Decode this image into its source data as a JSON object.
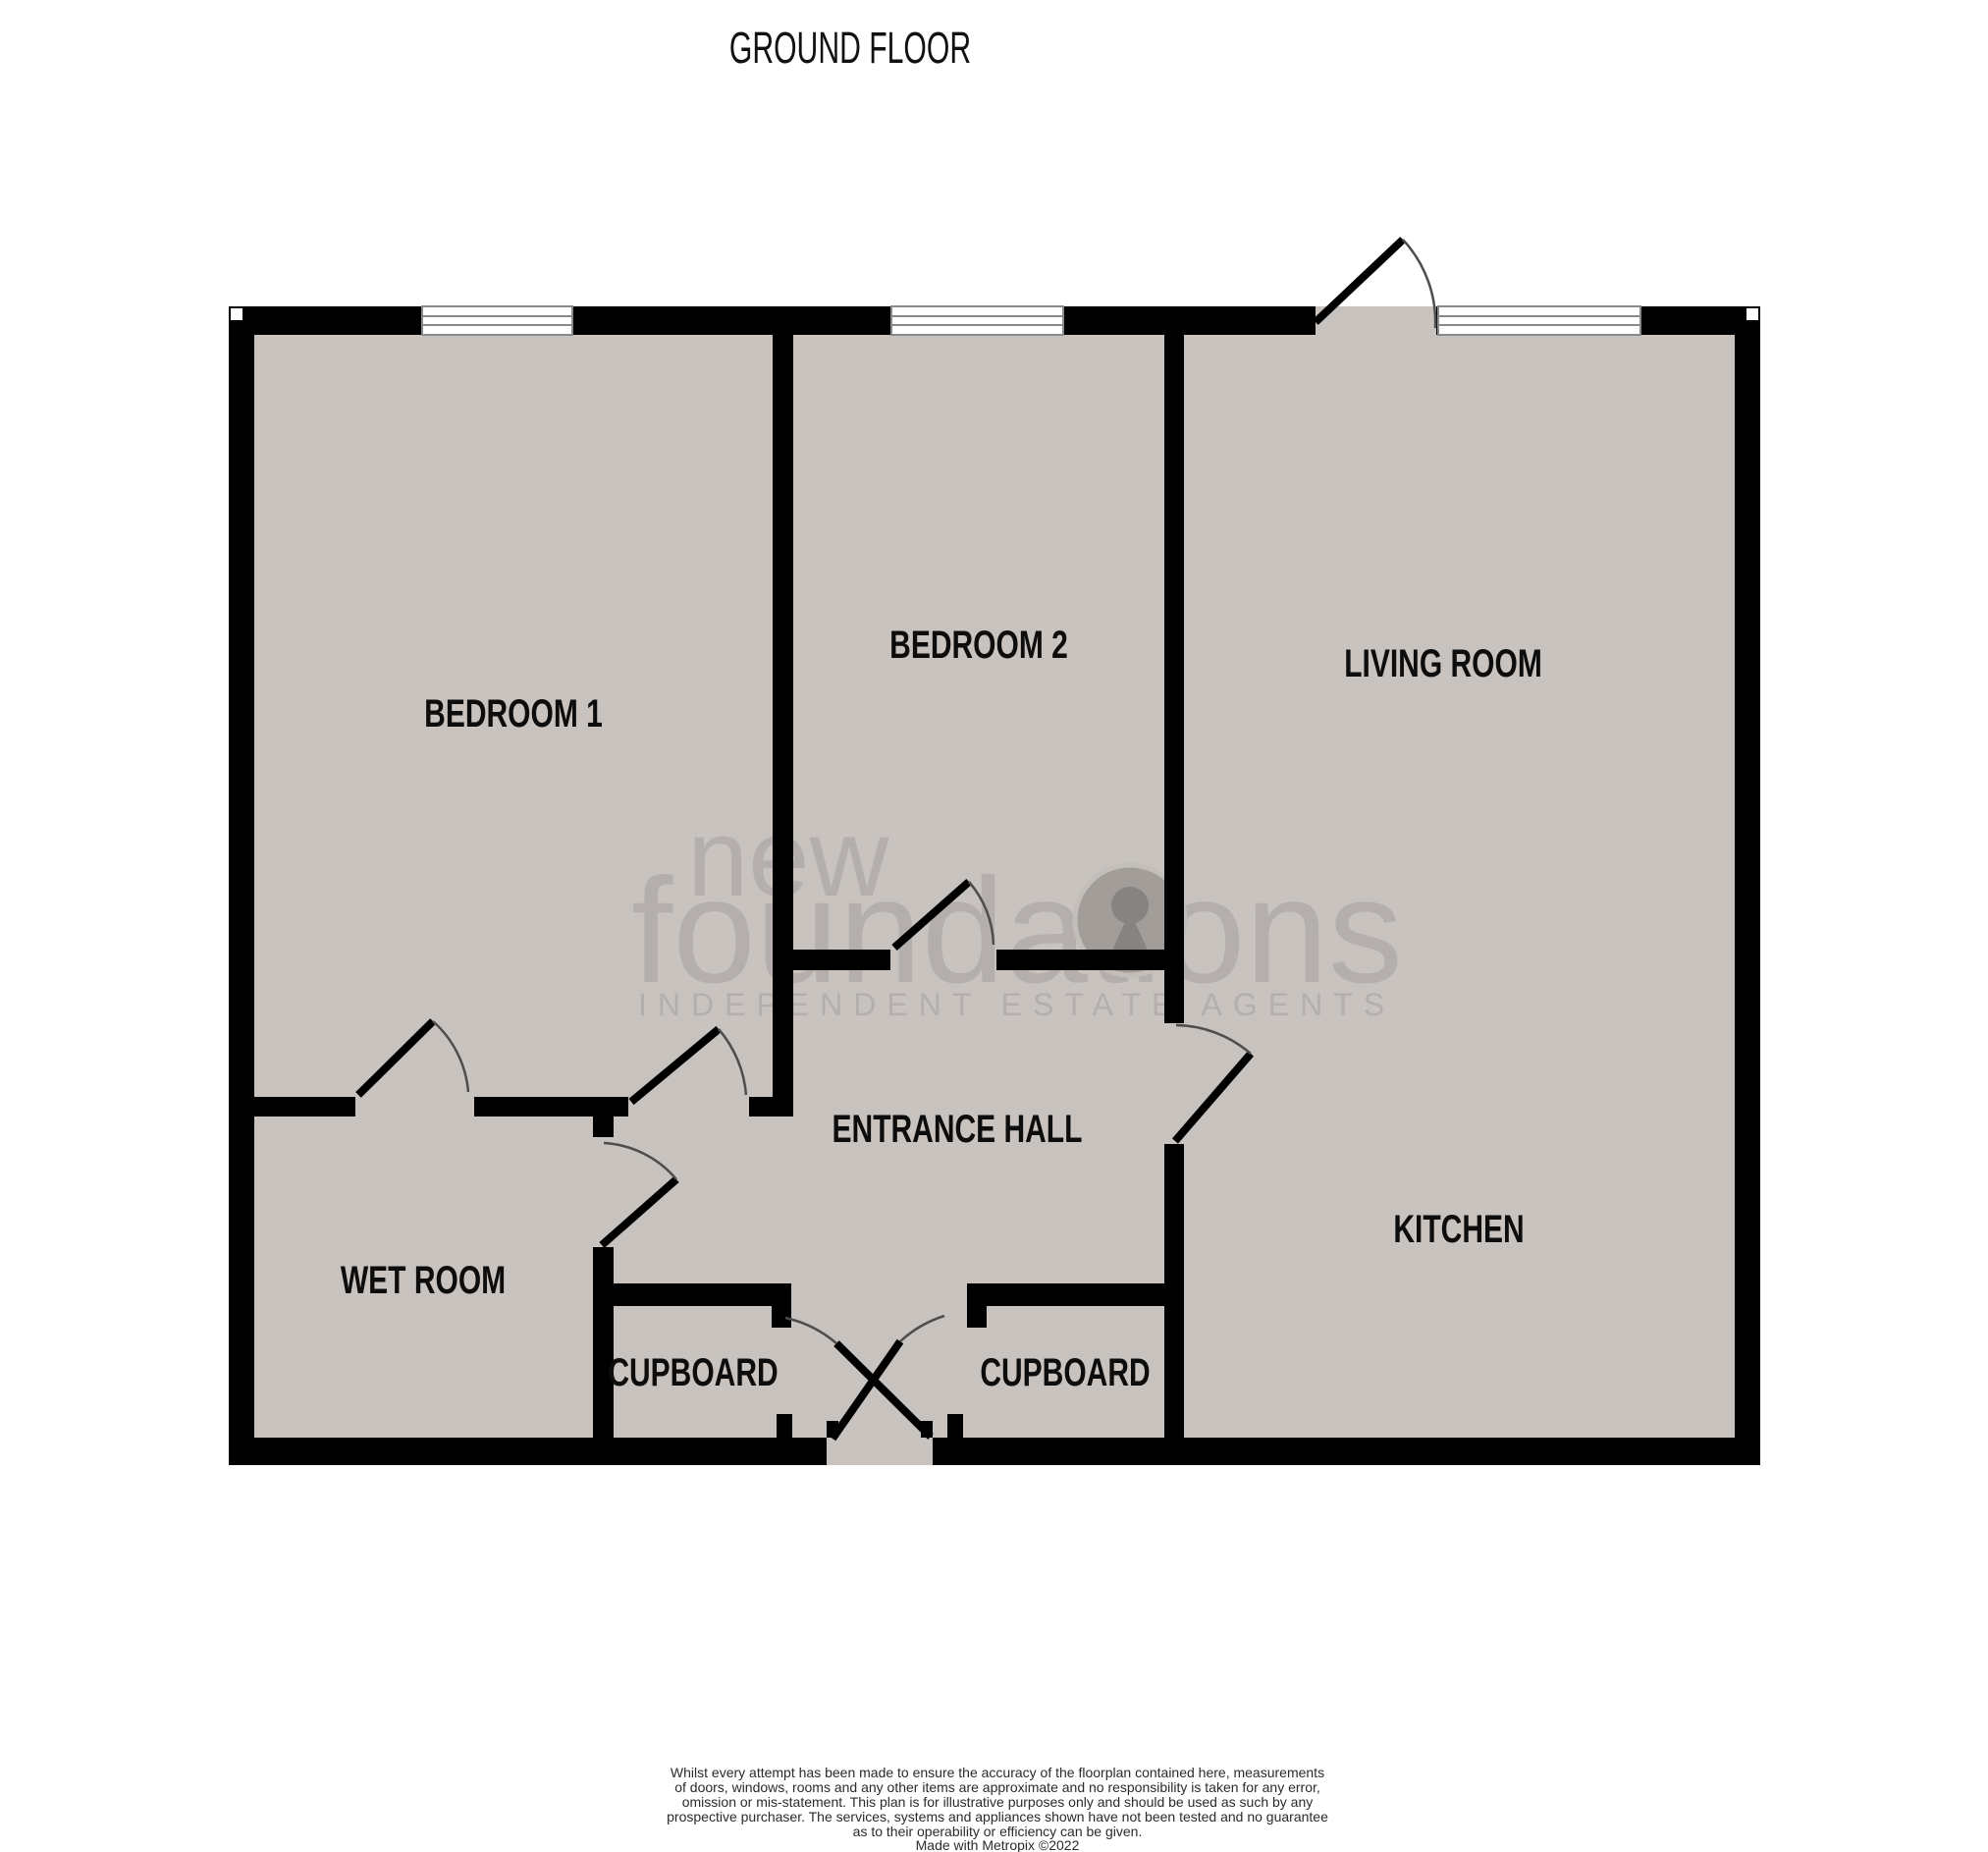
{
  "page": {
    "title": "GROUND FLOOR"
  },
  "floorplan": {
    "floor_color": "#c8c3bf",
    "wall_color": "#000000",
    "rooms": [
      {
        "id": "bedroom-1",
        "label": "BEDROOM 1"
      },
      {
        "id": "bedroom-2",
        "label": "BEDROOM 2"
      },
      {
        "id": "living-room",
        "label": "LIVING ROOM"
      },
      {
        "id": "entrance-hall",
        "label": "ENTRANCE HALL"
      },
      {
        "id": "wet-room",
        "label": "WET ROOM"
      },
      {
        "id": "kitchen",
        "label": "KITCHEN"
      },
      {
        "id": "cupboard-left",
        "label": "CUPBOARD"
      },
      {
        "id": "cupboard-right",
        "label": "CUPBOARD"
      }
    ]
  },
  "watermark": {
    "brand_top": "new",
    "brand_main": "foundations",
    "tagline": "INDEPENDENT ESTATE AGENTS"
  },
  "footer": {
    "disclaimer_lines": [
      "Whilst every attempt has been made to ensure the accuracy of the floorplan contained here, measurements",
      "of doors, windows, rooms and any other items are approximate and no responsibility is taken for any error,",
      "omission or mis-statement. This plan is for illustrative purposes only and should be used as such by any",
      "prospective purchaser. The services, systems and appliances shown have not been tested and no guarantee",
      "as to their operability or efficiency can be given."
    ],
    "credit": "Made with Metropix ©2022"
  }
}
